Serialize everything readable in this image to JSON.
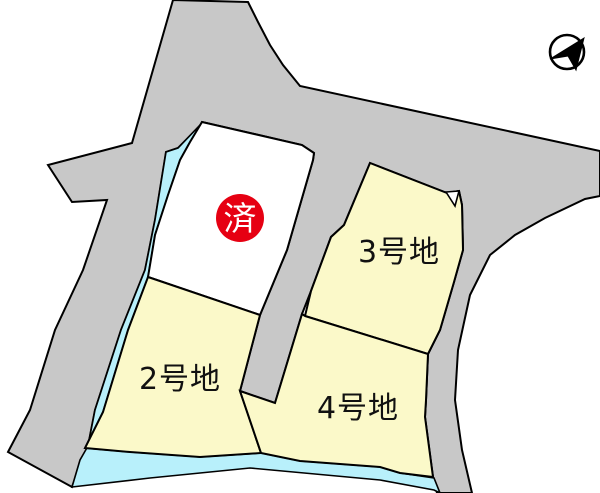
{
  "map": {
    "type": "residential-lot-map",
    "plots": {
      "sold": {
        "label": "済",
        "status": "sold",
        "shape": "white-parcel-with-red-badge"
      },
      "lot2": {
        "label": "2号地",
        "status": "available"
      },
      "lot3": {
        "label": "3号地",
        "status": "available"
      },
      "lot4": {
        "label": "4号地",
        "status": "available"
      }
    },
    "compass": {
      "icon": "north-arrow",
      "direction": "upper-right"
    }
  },
  "colors": {
    "road": "#c8c8c8",
    "plot_available": "#fbf9c9",
    "plot_sold": "#ffffff",
    "water_strip": "#b8f0fb",
    "sold_badge": "#e60012",
    "badge_text": "#ffffff",
    "outline": "#000000",
    "label_text": "#111111",
    "background": "#ffffff"
  }
}
